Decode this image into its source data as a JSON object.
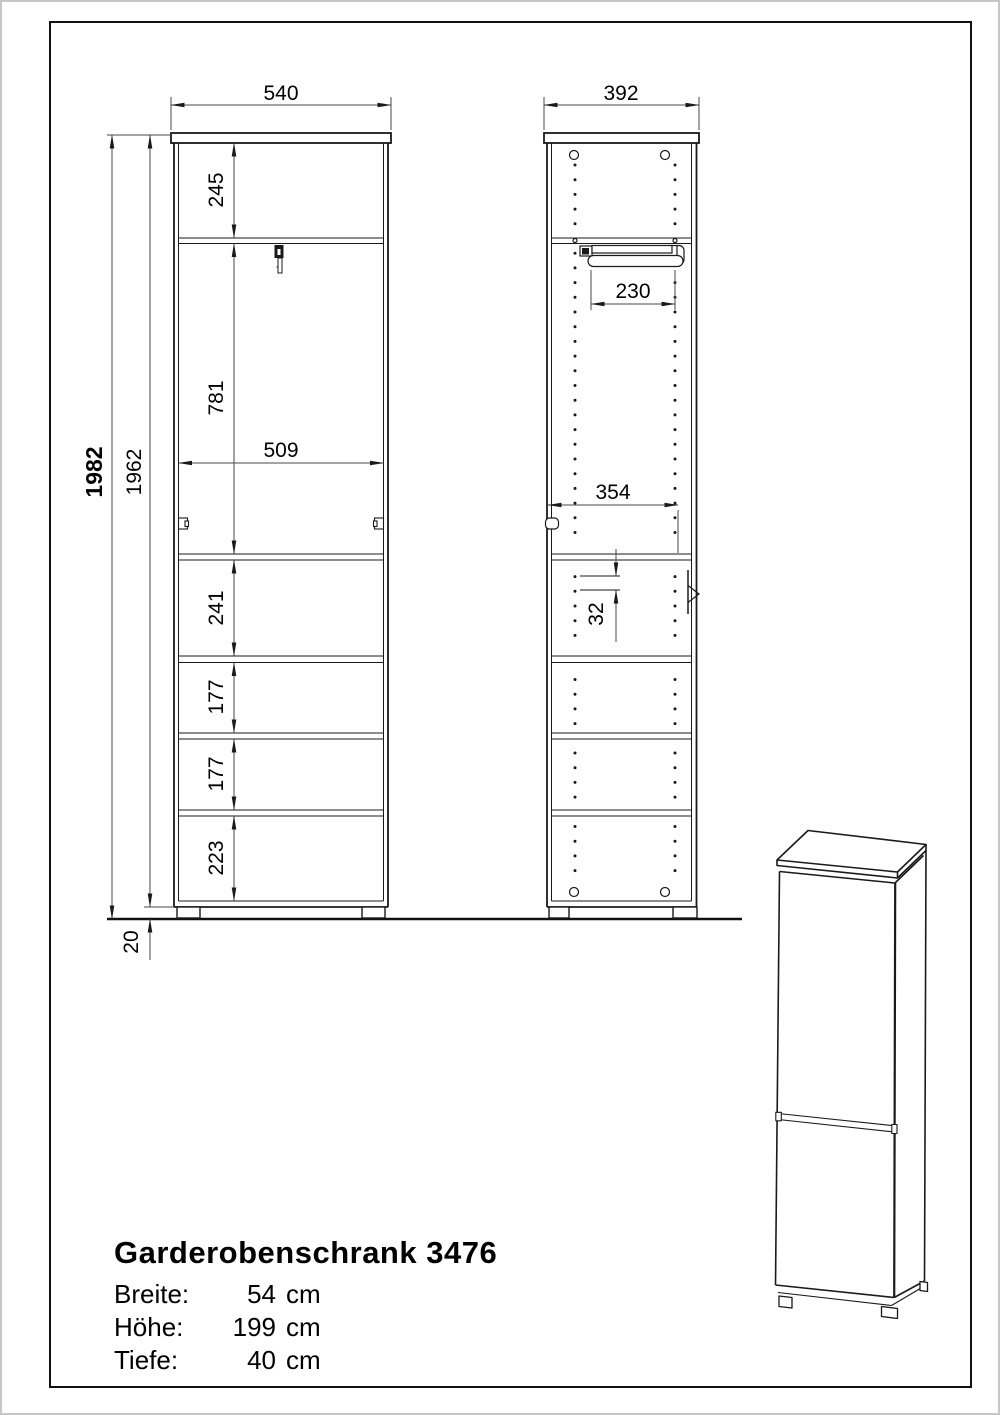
{
  "front_view": {
    "dims": {
      "width": "540",
      "opening_width": "509",
      "total_height": "1982",
      "body_height": "1962",
      "foot_height": "20",
      "top_section": "245",
      "upper_section": "781",
      "section_1": "241",
      "section_2": "177",
      "section_3": "177",
      "bottom_section": "223"
    }
  },
  "side_view": {
    "dims": {
      "depth": "392",
      "rail_depth": "230",
      "inner_depth": "354",
      "hole_pitch": "32"
    }
  },
  "title_block": {
    "title": "Garderobenschrank 3476",
    "specs": [
      {
        "label": "Breite:",
        "value": "54",
        "unit": "cm"
      },
      {
        "label": "Höhe:",
        "value": "199",
        "unit": "cm"
      },
      {
        "label": "Tiefe:",
        "value": "40",
        "unit": "cm"
      }
    ]
  },
  "colors": {
    "line": "#1a1a1a",
    "dim_line": "#4a4a4a",
    "background": "#ffffff",
    "page_edge": "#c6c6c6"
  }
}
